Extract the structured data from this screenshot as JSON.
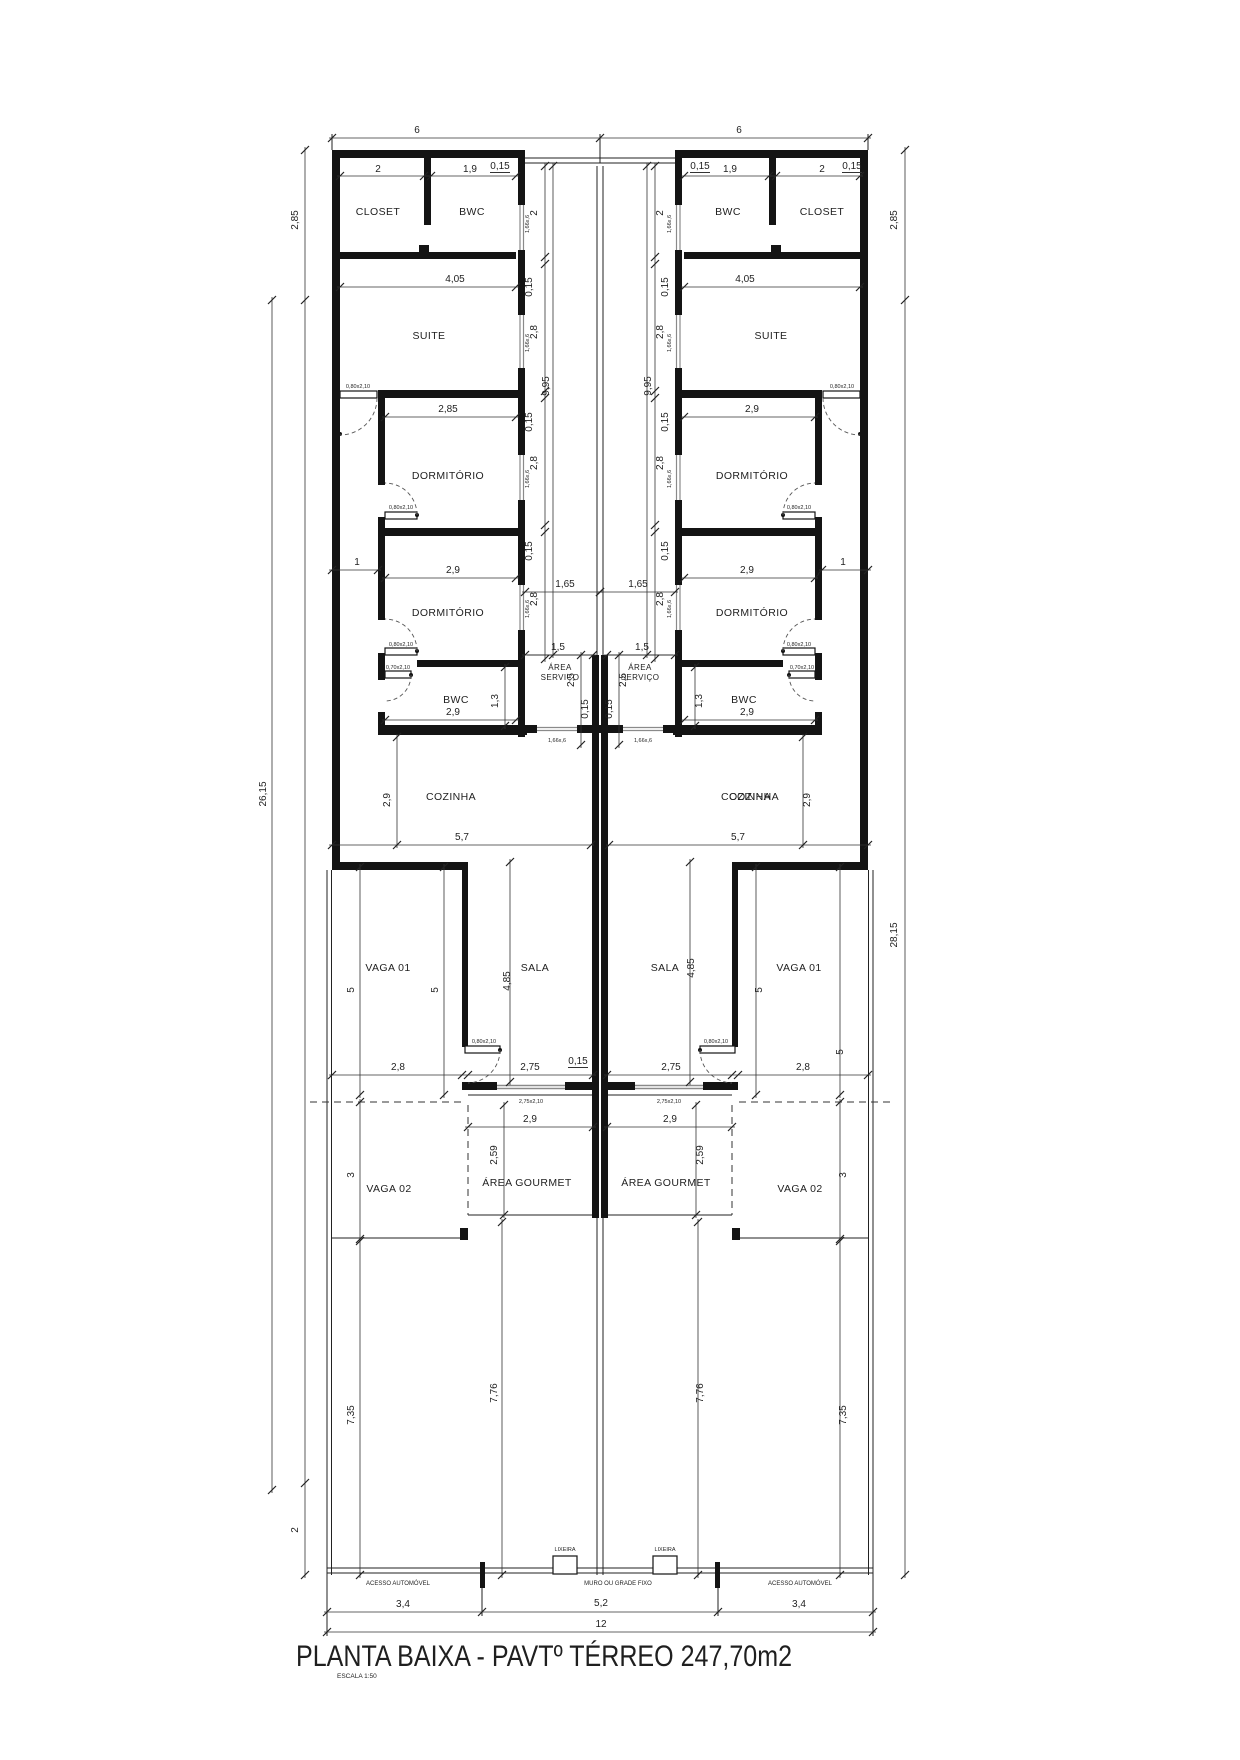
{
  "title": {
    "text": "PLANTA   BAIXA - PAVTº TÉRREO  247,70m2",
    "scale": "ESCALA 1:50"
  },
  "rooms": {
    "closet": "CLOSET",
    "bwc": "BWC",
    "suite": "SUITE",
    "dorm": "DORMITÓRIO",
    "area1": "ÁREA",
    "area2": "SERVIÇO",
    "cozinha": "COZINHA",
    "sala": "SALA",
    "vaga01": "VAGA 01",
    "vaga02": "VAGA 02",
    "gourmet": "ÁREA GOURMET"
  },
  "dims": {
    "d6": "6",
    "d2": "2",
    "d1_9": "1,9",
    "d0_15": "0,15",
    "d2_85": "2,85",
    "d4_05": "4,05",
    "d2_8": "2,8",
    "d9_95": "9,95",
    "d1": "1",
    "d2_9": "2,9",
    "d1_65": "1,65",
    "d1_5": "1,5",
    "d2_5": "2,5",
    "d1_3": "1,3",
    "d5_7": "5,7",
    "d26_15": "26,15",
    "d28_15": "28,15",
    "d5": "5",
    "d4_85": "4,85",
    "d2_75": "2,75",
    "d2_59": "2,59",
    "d3": "3",
    "d7_35": "7,35",
    "d7_76": "7,76",
    "d3_4": "3,4",
    "d5_2": "5,2",
    "d12": "12"
  },
  "tags": {
    "window": "1,66x,6",
    "door80": "0,80x2,10",
    "door70": "0,70x2,10",
    "slider": "2,75x2,10"
  },
  "annotations": {
    "lixeira": "LIXEIRA",
    "acesso": "ACESSO AUTOMÓVEL",
    "muro": "MURO OU GRADE FIXO"
  }
}
